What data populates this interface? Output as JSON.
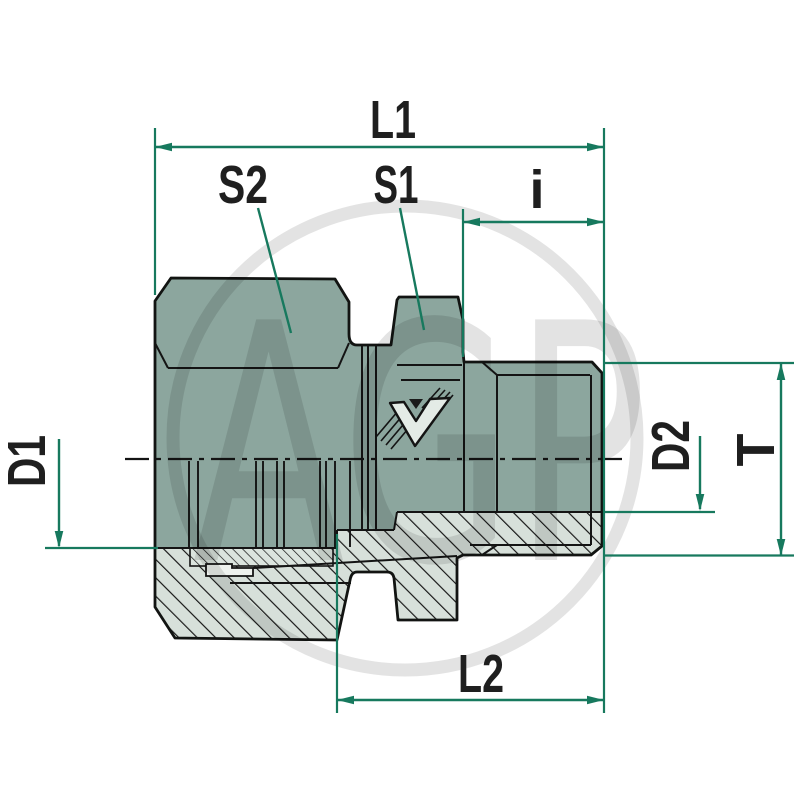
{
  "drawing": {
    "type": "technical-drawing-hydraulic-fitting-cross-section",
    "dimension_labels": {
      "l1": "L1",
      "s2": "S2",
      "s1": "S1",
      "i": "i",
      "d1": "D1",
      "d2": "D2",
      "t": "T",
      "l2": "L2"
    },
    "watermark_text": "AGP",
    "colors": {
      "body_fill": "#8ca69e",
      "section_fill": "#d7e0da",
      "ferrule_fill": "#eef2ee",
      "dimension_line": "#17795e",
      "outline": "#121412",
      "background": "#ffffff"
    }
  }
}
